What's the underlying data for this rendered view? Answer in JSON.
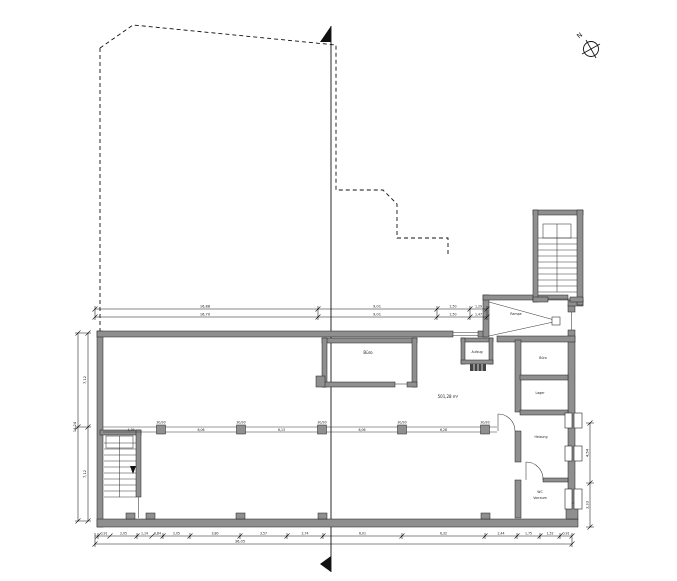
{
  "compass": {
    "north_label": "N"
  },
  "rooms": {
    "mid_room": "Büro",
    "lift": "Aufzug",
    "hall_area": "501,28 m²",
    "right_room_1": "Büro",
    "right_room_2": "Lager",
    "right_room_3": "Heizung",
    "right_room_4_line1": "WC",
    "right_room_4_line2": "Vorraum",
    "ramp": "Rampe"
  },
  "dims": {
    "top1": [
      "16,88",
      "9,01",
      "2,50",
      "1,29"
    ],
    "top2": [
      "16,70",
      "9,01",
      "2,50",
      "1,47"
    ],
    "left_outer": "14,24",
    "left_upper": "7,12",
    "left_lower": "7,12",
    "right_upper": "4,54",
    "right_lower": "3,33",
    "bottom": [
      "0,91",
      "2,05",
      "1,14",
      "0,84",
      "2,05",
      "3,80",
      "3,57",
      "2,74",
      "6,01",
      "6,32",
      "2,44",
      "1,75",
      "1,52",
      "0,91"
    ],
    "bottom_total": "36,05",
    "col_size": "30/30",
    "col_spans": [
      "4,39",
      "6,06",
      "6,13",
      "6,06",
      "6,28"
    ]
  }
}
